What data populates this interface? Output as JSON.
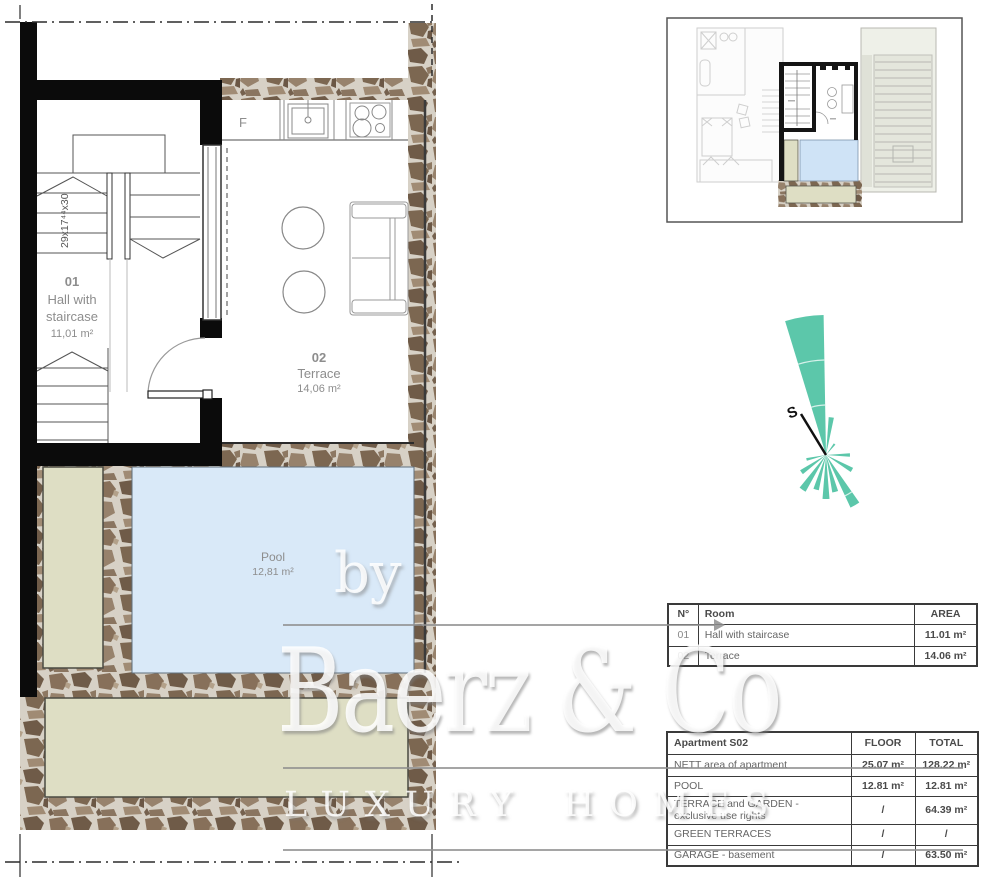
{
  "plan": {
    "room01": {
      "id": "01",
      "line1": "Hall with",
      "line2": "staircase",
      "area": "11,01 m²"
    },
    "room02": {
      "id": "02",
      "name": "Terrace",
      "area": "14,06 m²"
    },
    "pool": {
      "name": "Pool",
      "area": "12,81 m²"
    },
    "stair_note": "29x17⁴⁴x30",
    "fridge_label": "F"
  },
  "compass": {
    "south_label": "S"
  },
  "room_table": {
    "col_no": "N°",
    "col_room": "Room",
    "col_area": "AREA",
    "rows": [
      {
        "no": "01",
        "room": "Hall with staircase",
        "area": "11.01 m²"
      },
      {
        "no": "02",
        "room": "Terrace",
        "area": "14.06 m²"
      }
    ]
  },
  "summary_table": {
    "title": "Apartment S02",
    "col_floor": "FLOOR",
    "col_total": "TOTAL",
    "rows": [
      {
        "label": "NETT area of apartment",
        "floor": "25.07 m²",
        "total": "128.22 m²"
      },
      {
        "label": "POOL",
        "floor": "12.81 m²",
        "total": "12.81 m²"
      },
      {
        "label": "TERRACE and GARDEN - exclusive use rights",
        "floor": "/",
        "total": "64.39 m²"
      },
      {
        "label": "GREEN TERRACES",
        "floor": "/",
        "total": "/"
      },
      {
        "label": "GARAGE - basement",
        "floor": "/",
        "total": "63.50 m²"
      }
    ]
  },
  "watermark": {
    "prefix": "by",
    "brand": "Baerz & Co",
    "tagline": "LUXURY HOMES"
  },
  "colors": {
    "pool_blue": "#d9e9f8",
    "terrace_green": "#dedec4",
    "compass_teal": "#4ec2a3",
    "wall_black": "#0b0b0b",
    "stone_mortar": "#d7d1c6",
    "label_grey": "#8d8d8d"
  }
}
